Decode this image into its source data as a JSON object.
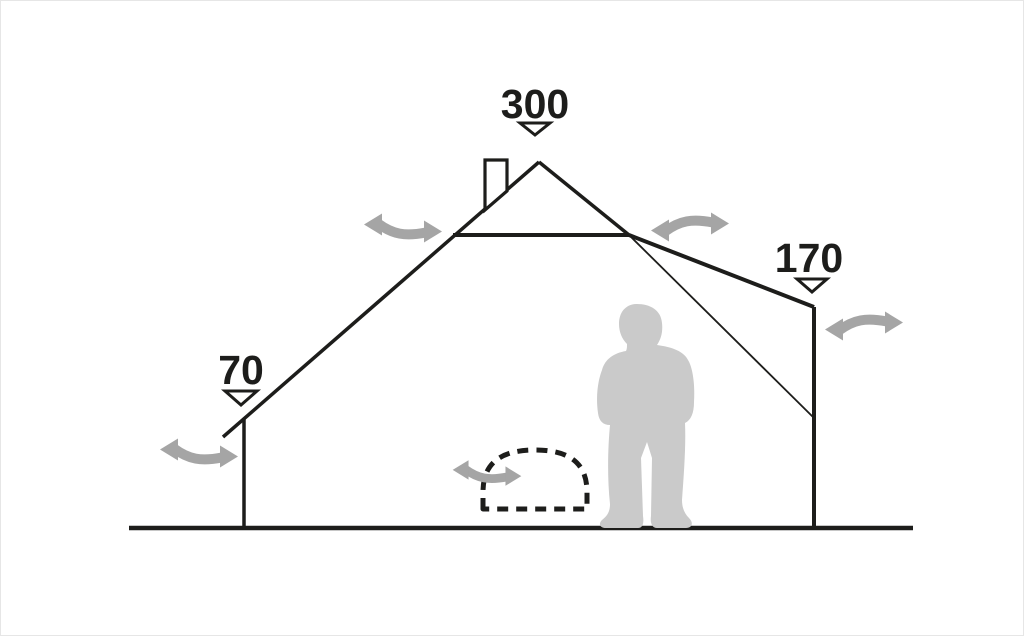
{
  "diagram": {
    "description": "tent-cross-section-dimension-diagram",
    "labels": {
      "peak_height": "300",
      "right_wall_height": "170",
      "left_wall_height": "70"
    },
    "colors": {
      "line": "#1d1d1b",
      "arrow": "#a5a5a5",
      "silhouette": "#cacaca",
      "background": "#ffffff"
    },
    "icons": [
      {
        "name": "ventilation-arrow-icon",
        "shape": "s-curve double-headed arrow",
        "count": 5
      },
      {
        "name": "dimension-marker-icon",
        "shape": "down-pointing outlined triangle",
        "count": 3
      },
      {
        "name": "chimney-icon",
        "shape": "rectangular flue on left roof slope"
      },
      {
        "name": "stove-dashed-outline",
        "shape": "dashed half-dome on ground"
      },
      {
        "name": "person-silhouette",
        "shape": "standing human figure for scale"
      }
    ]
  }
}
